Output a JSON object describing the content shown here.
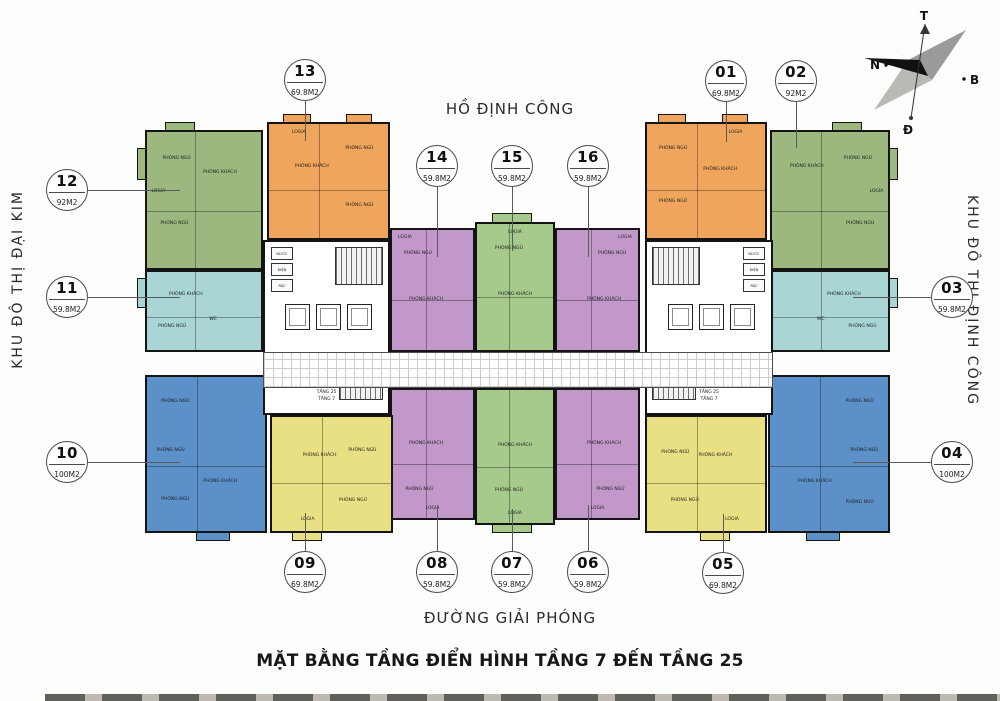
{
  "title": "MẶT BẰNG TẦNG ĐIỂN HÌNH TẦNG 7 ĐẾN TẦNG 25",
  "roads": {
    "top": "HỒ ĐỊNH CÔNG",
    "bottom": "ĐƯỜNG GIẢI PHÓNG",
    "left": "KHU ĐÔ THỊ ĐẠI KIM",
    "right": "KHU ĐÔ THỊ ĐỊNH CÔNG"
  },
  "compass": {
    "top": "T",
    "right": "B",
    "bottom": "Đ",
    "left": "N"
  },
  "palette": {
    "orange": "#EFA55C",
    "green": "#9CB87E",
    "green2": "#A6C98C",
    "cyan": "#A9D6D5",
    "blue": "#5C90C8",
    "yellow": "#E9E083",
    "purple": "#C298CA",
    "wall": "#141414"
  },
  "room_labels": {
    "bedroom": "PHÒNG NGỦ",
    "living": "PHÒNG KHÁCH",
    "kitchen": "BẾP",
    "wc": "WC",
    "logia": "LOGIA",
    "dining": "P.ĂN"
  },
  "cores": {
    "shafts": [
      "NƯỚC",
      "ĐIỆN",
      "RÁC"
    ],
    "levels": [
      "TẦNG 25",
      "TẦNG 7"
    ],
    "boxes": [
      {
        "x": 263,
        "y": 240,
        "w": 127,
        "h": 175,
        "flip": false
      },
      {
        "x": 645,
        "y": 240,
        "w": 128,
        "h": 175,
        "flip": true
      }
    ]
  },
  "corridor": {
    "x": 263,
    "y": 352,
    "w": 510,
    "h": 36
  },
  "units": [
    {
      "id": "01",
      "area": "69.8M2",
      "color": "orange",
      "block": {
        "x": 645,
        "y": 122,
        "w": 122,
        "h": 118
      },
      "callout": {
        "x": 726,
        "y": 81
      },
      "leader": {
        "dir": "down",
        "len": 40
      },
      "rooms": [
        {
          "k": "bedroom",
          "x": 22,
          "y": 22
        },
        {
          "k": "bedroom",
          "x": 22,
          "y": 68
        },
        {
          "k": "living",
          "x": 62,
          "y": 40
        },
        {
          "k": "logia",
          "x": 75,
          "y": 8
        }
      ]
    },
    {
      "id": "02",
      "area": "92M2",
      "color": "green",
      "block": {
        "x": 770,
        "y": 130,
        "w": 120,
        "h": 140
      },
      "callout": {
        "x": 796,
        "y": 81
      },
      "leader": {
        "dir": "down",
        "len": 46
      },
      "rooms": [
        {
          "k": "living",
          "x": 30,
          "y": 26
        },
        {
          "k": "bedroom",
          "x": 74,
          "y": 20
        },
        {
          "k": "bedroom",
          "x": 76,
          "y": 68
        },
        {
          "k": "logia",
          "x": 90,
          "y": 44
        }
      ]
    },
    {
      "id": "03",
      "area": "59.8M2",
      "color": "cyan",
      "block": {
        "x": 770,
        "y": 270,
        "w": 120,
        "h": 82
      },
      "callout": {
        "x": 952,
        "y": 297
      },
      "leader": {
        "dir": "left",
        "len": 78
      },
      "rooms": [
        {
          "k": "living",
          "x": 62,
          "y": 30
        },
        {
          "k": "bedroom",
          "x": 78,
          "y": 70
        },
        {
          "k": "wc",
          "x": 42,
          "y": 62
        }
      ]
    },
    {
      "id": "04",
      "area": "100M2",
      "color": "blue",
      "block": {
        "x": 768,
        "y": 375,
        "w": 122,
        "h": 158
      },
      "callout": {
        "x": 952,
        "y": 462
      },
      "leader": {
        "dir": "left",
        "len": 78
      },
      "rooms": [
        {
          "k": "bedroom",
          "x": 76,
          "y": 16
        },
        {
          "k": "bedroom",
          "x": 80,
          "y": 48
        },
        {
          "k": "bedroom",
          "x": 76,
          "y": 82
        },
        {
          "k": "living",
          "x": 38,
          "y": 68
        }
      ]
    },
    {
      "id": "05",
      "area": "69.8M2",
      "color": "yellow",
      "block": {
        "x": 645,
        "y": 415,
        "w": 122,
        "h": 118
      },
      "callout": {
        "x": 723,
        "y": 573
      },
      "leader": {
        "dir": "up",
        "len": 38
      },
      "rooms": [
        {
          "k": "living",
          "x": 58,
          "y": 34
        },
        {
          "k": "bedroom",
          "x": 24,
          "y": 32
        },
        {
          "k": "bedroom",
          "x": 32,
          "y": 74
        },
        {
          "k": "logia",
          "x": 72,
          "y": 90
        }
      ]
    },
    {
      "id": "06",
      "area": "59.8M2",
      "color": "purple",
      "block": {
        "x": 555,
        "y": 388,
        "w": 85,
        "h": 132
      },
      "callout": {
        "x": 588,
        "y": 572
      },
      "leader": {
        "dir": "up",
        "len": 46
      },
      "rooms": [
        {
          "k": "living",
          "x": 58,
          "y": 42
        },
        {
          "k": "bedroom",
          "x": 66,
          "y": 78
        },
        {
          "k": "logia",
          "x": 50,
          "y": 93
        }
      ]
    },
    {
      "id": "07",
      "area": "59.8M2",
      "color": "green2",
      "block": {
        "x": 475,
        "y": 388,
        "w": 80,
        "h": 137
      },
      "callout": {
        "x": 512,
        "y": 572
      },
      "leader": {
        "dir": "up",
        "len": 42
      },
      "rooms": [
        {
          "k": "living",
          "x": 50,
          "y": 42
        },
        {
          "k": "bedroom",
          "x": 42,
          "y": 76
        },
        {
          "k": "logia",
          "x": 50,
          "y": 93
        }
      ]
    },
    {
      "id": "08",
      "area": "59.8M2",
      "color": "purple",
      "block": {
        "x": 390,
        "y": 388,
        "w": 85,
        "h": 132
      },
      "callout": {
        "x": 437,
        "y": 572
      },
      "leader": {
        "dir": "up",
        "len": 46
      },
      "rooms": [
        {
          "k": "living",
          "x": 42,
          "y": 42
        },
        {
          "k": "bedroom",
          "x": 34,
          "y": 78
        },
        {
          "k": "logia",
          "x": 50,
          "y": 93
        }
      ]
    },
    {
      "id": "09",
      "area": "69.8M2",
      "color": "yellow",
      "block": {
        "x": 270,
        "y": 415,
        "w": 123,
        "h": 118
      },
      "callout": {
        "x": 305,
        "y": 572
      },
      "leader": {
        "dir": "up",
        "len": 38
      },
      "rooms": [
        {
          "k": "living",
          "x": 40,
          "y": 34
        },
        {
          "k": "bedroom",
          "x": 76,
          "y": 30
        },
        {
          "k": "bedroom",
          "x": 68,
          "y": 74
        },
        {
          "k": "logia",
          "x": 30,
          "y": 90
        }
      ]
    },
    {
      "id": "10",
      "area": "100M2",
      "color": "blue",
      "block": {
        "x": 145,
        "y": 375,
        "w": 122,
        "h": 158
      },
      "callout": {
        "x": 67,
        "y": 462
      },
      "leader": {
        "dir": "right",
        "len": 92
      },
      "rooms": [
        {
          "k": "bedroom",
          "x": 24,
          "y": 16
        },
        {
          "k": "bedroom",
          "x": 20,
          "y": 48
        },
        {
          "k": "bedroom",
          "x": 24,
          "y": 80
        },
        {
          "k": "living",
          "x": 62,
          "y": 68
        }
      ]
    },
    {
      "id": "11",
      "area": "59.8M2",
      "color": "cyan",
      "block": {
        "x": 145,
        "y": 270,
        "w": 118,
        "h": 82
      },
      "callout": {
        "x": 67,
        "y": 297
      },
      "leader": {
        "dir": "right",
        "len": 92
      },
      "rooms": [
        {
          "k": "living",
          "x": 34,
          "y": 30
        },
        {
          "k": "bedroom",
          "x": 22,
          "y": 70
        },
        {
          "k": "wc",
          "x": 58,
          "y": 62
        }
      ]
    },
    {
      "id": "12",
      "area": "92M2",
      "color": "green",
      "block": {
        "x": 145,
        "y": 130,
        "w": 118,
        "h": 140
      },
      "callout": {
        "x": 67,
        "y": 190
      },
      "leader": {
        "dir": "right",
        "len": 92
      },
      "rooms": [
        {
          "k": "bedroom",
          "x": 26,
          "y": 20
        },
        {
          "k": "living",
          "x": 64,
          "y": 30
        },
        {
          "k": "bedroom",
          "x": 24,
          "y": 68
        },
        {
          "k": "logia",
          "x": 10,
          "y": 44
        }
      ]
    },
    {
      "id": "13",
      "area": "69.8M2",
      "color": "orange",
      "block": {
        "x": 267,
        "y": 122,
        "w": 123,
        "h": 118
      },
      "callout": {
        "x": 305,
        "y": 80
      },
      "leader": {
        "dir": "down",
        "len": 40
      },
      "rooms": [
        {
          "k": "bedroom",
          "x": 76,
          "y": 22
        },
        {
          "k": "living",
          "x": 36,
          "y": 38
        },
        {
          "k": "bedroom",
          "x": 76,
          "y": 72
        },
        {
          "k": "logia",
          "x": 25,
          "y": 8
        }
      ]
    },
    {
      "id": "14",
      "area": "59.8M2",
      "color": "purple",
      "block": {
        "x": 390,
        "y": 228,
        "w": 85,
        "h": 124
      },
      "callout": {
        "x": 437,
        "y": 166
      },
      "leader": {
        "dir": "down",
        "len": 70
      },
      "rooms": [
        {
          "k": "bedroom",
          "x": 32,
          "y": 20
        },
        {
          "k": "living",
          "x": 42,
          "y": 58
        },
        {
          "k": "logia",
          "x": 16,
          "y": 7
        }
      ]
    },
    {
      "id": "15",
      "area": "59.8M2",
      "color": "green2",
      "block": {
        "x": 475,
        "y": 222,
        "w": 80,
        "h": 130
      },
      "callout": {
        "x": 512,
        "y": 166
      },
      "leader": {
        "dir": "down",
        "len": 64
      },
      "rooms": [
        {
          "k": "bedroom",
          "x": 42,
          "y": 20
        },
        {
          "k": "living",
          "x": 50,
          "y": 56
        },
        {
          "k": "logia",
          "x": 50,
          "y": 7
        }
      ]
    },
    {
      "id": "16",
      "area": "59.8M2",
      "color": "purple",
      "block": {
        "x": 555,
        "y": 228,
        "w": 85,
        "h": 124
      },
      "callout": {
        "x": 588,
        "y": 166
      },
      "leader": {
        "dir": "down",
        "len": 70
      },
      "rooms": [
        {
          "k": "bedroom",
          "x": 68,
          "y": 20
        },
        {
          "k": "living",
          "x": 58,
          "y": 58
        },
        {
          "k": "logia",
          "x": 84,
          "y": 7
        }
      ]
    }
  ],
  "balconies": [
    {
      "x": 283,
      "y": 114,
      "w": 28,
      "h": 9,
      "color": "orange"
    },
    {
      "x": 346,
      "y": 114,
      "w": 26,
      "h": 9,
      "color": "orange"
    },
    {
      "x": 658,
      "y": 114,
      "w": 28,
      "h": 9,
      "color": "orange"
    },
    {
      "x": 722,
      "y": 114,
      "w": 26,
      "h": 9,
      "color": "orange"
    },
    {
      "x": 165,
      "y": 122,
      "w": 30,
      "h": 9,
      "color": "green"
    },
    {
      "x": 832,
      "y": 122,
      "w": 30,
      "h": 9,
      "color": "green"
    },
    {
      "x": 492,
      "y": 213,
      "w": 40,
      "h": 10,
      "color": "green2"
    },
    {
      "x": 137,
      "y": 148,
      "w": 9,
      "h": 32,
      "color": "green"
    },
    {
      "x": 137,
      "y": 278,
      "w": 9,
      "h": 30,
      "color": "cyan"
    },
    {
      "x": 889,
      "y": 148,
      "w": 9,
      "h": 32,
      "color": "green"
    },
    {
      "x": 889,
      "y": 278,
      "w": 9,
      "h": 30,
      "color": "cyan"
    },
    {
      "x": 196,
      "y": 532,
      "w": 34,
      "h": 9,
      "color": "blue"
    },
    {
      "x": 292,
      "y": 532,
      "w": 30,
      "h": 9,
      "color": "yellow"
    },
    {
      "x": 700,
      "y": 532,
      "w": 30,
      "h": 9,
      "color": "yellow"
    },
    {
      "x": 806,
      "y": 532,
      "w": 34,
      "h": 9,
      "color": "blue"
    },
    {
      "x": 492,
      "y": 524,
      "w": 40,
      "h": 9,
      "color": "green2"
    }
  ]
}
